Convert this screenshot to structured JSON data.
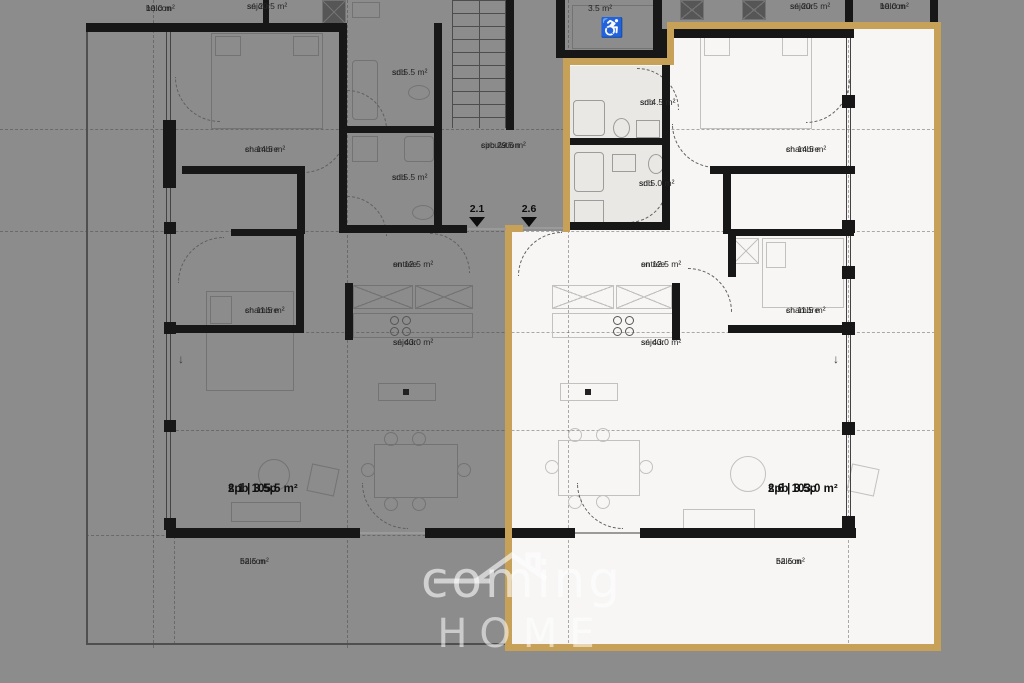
{
  "background_color": "#8c8c8c",
  "highlight_color": "#c7a157",
  "watermark": {
    "line1": "coming",
    "line2": "HOME"
  },
  "elevator": {
    "area": "3.5 m²"
  },
  "units": [
    {
      "id": "2.1",
      "title": "2.1 | 3.5p",
      "area": "spb 105.5 m²"
    },
    {
      "id": "2.6",
      "title": "2.6 | 3.5p",
      "area": "spb 103.0 m²"
    }
  ],
  "door_markers": [
    {
      "label": "2.1",
      "x": 477
    },
    {
      "label": "2.6",
      "x": 529
    }
  ],
  "rooms": [
    {
      "name": "balcon",
      "area": "10.0 m²",
      "x": 146,
      "y": 3,
      "zone": "gray"
    },
    {
      "name": "séjour",
      "area": "sn 20.5 m²",
      "x": 247,
      "y": 1,
      "zone": "gray"
    },
    {
      "name": "chambre",
      "area": "sn 14.5 m²",
      "x": 245,
      "y": 144,
      "zone": "gray"
    },
    {
      "name": "sdb",
      "area": "sn 5.5 m²",
      "x": 392,
      "y": 67,
      "zone": "gray"
    },
    {
      "name": "sdb",
      "area": "sn 5.5 m²",
      "x": 392,
      "y": 172,
      "zone": "gray"
    },
    {
      "name": "circulation",
      "area": "spb 29.5 m²",
      "x": 481,
      "y": 140,
      "zone": "gray"
    },
    {
      "name": "chambre",
      "area": "sn 11.5 m²",
      "x": 245,
      "y": 305,
      "zone": "gray"
    },
    {
      "name": "entrée",
      "area": "sn 12.5 m²",
      "x": 393,
      "y": 259,
      "zone": "gray"
    },
    {
      "name": "séjour",
      "area": "sn 43.0 m²",
      "x": 393,
      "y": 337,
      "zone": "gray"
    },
    {
      "name": "balcon",
      "area": "52.5 m²",
      "x": 240,
      "y": 556,
      "zone": "gray"
    },
    {
      "name": "séjour",
      "area": "sn 20.5 m²",
      "x": 790,
      "y": 1,
      "zone": "gray"
    },
    {
      "name": "balcon",
      "area": "10.0 m²",
      "x": 880,
      "y": 1,
      "zone": "gray"
    },
    {
      "name": "sdb",
      "area": "sn 4.5 m²",
      "x": 640,
      "y": 97,
      "zone": "white"
    },
    {
      "name": "sdb",
      "area": "sn 5.0 m²",
      "x": 639,
      "y": 178,
      "zone": "white"
    },
    {
      "name": "chambre",
      "area": "sn 14.5 m²",
      "x": 786,
      "y": 144,
      "zone": "white"
    },
    {
      "name": "entrée",
      "area": "sn 12.5 m²",
      "x": 641,
      "y": 259,
      "zone": "white"
    },
    {
      "name": "séjour",
      "area": "sn 43.0 m²",
      "x": 641,
      "y": 337,
      "zone": "white"
    },
    {
      "name": "chambre",
      "area": "sn 11.5 m²",
      "x": 786,
      "y": 305,
      "zone": "white"
    },
    {
      "name": "balcon",
      "area": "52.5 m²",
      "x": 776,
      "y": 556,
      "zone": "white"
    }
  ]
}
